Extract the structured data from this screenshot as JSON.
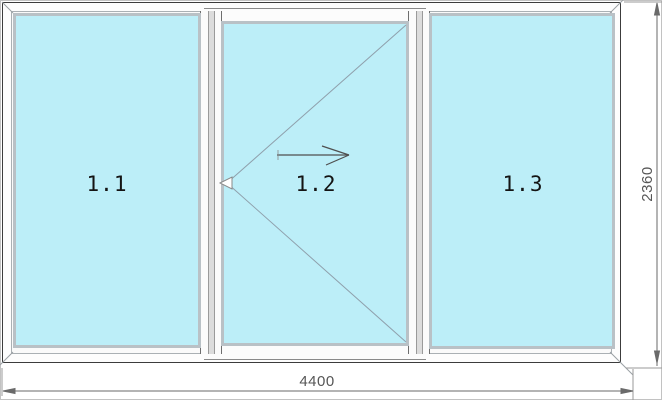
{
  "drawing": {
    "title": "three-section sliding window elevation",
    "panels": [
      {
        "label": "1.1",
        "type": "fixed"
      },
      {
        "label": "1.2",
        "type": "sliding",
        "symbols": [
          "opening-v",
          "slide-arrow-right"
        ]
      },
      {
        "label": "1.3",
        "type": "fixed"
      }
    ],
    "dimensions": {
      "width": "4400",
      "height": "2360"
    },
    "colors": {
      "glass": "#bceef8",
      "glass_bevel": "#b9c1c6",
      "frame_outline": "#3c3c3c",
      "mullion_shade": "#dcdcdc",
      "opening_symbol": "#8fa0ac",
      "dimension": "#5a5a5a",
      "label_text": "#141414"
    }
  }
}
